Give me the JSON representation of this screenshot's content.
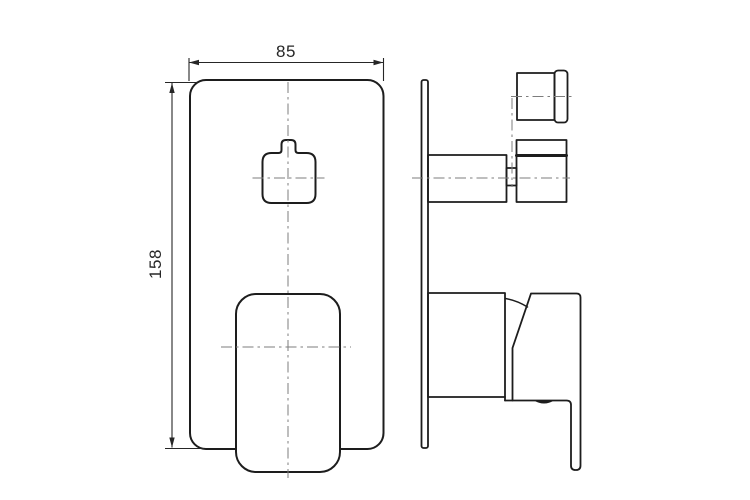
{
  "drawing": {
    "dimension_labels": {
      "width": "85",
      "height": "158"
    },
    "colors": {
      "background": "#ffffff",
      "object_line": "#1d1d1d",
      "center_line": "#7d7d7d",
      "dimension": "#262626"
    }
  }
}
